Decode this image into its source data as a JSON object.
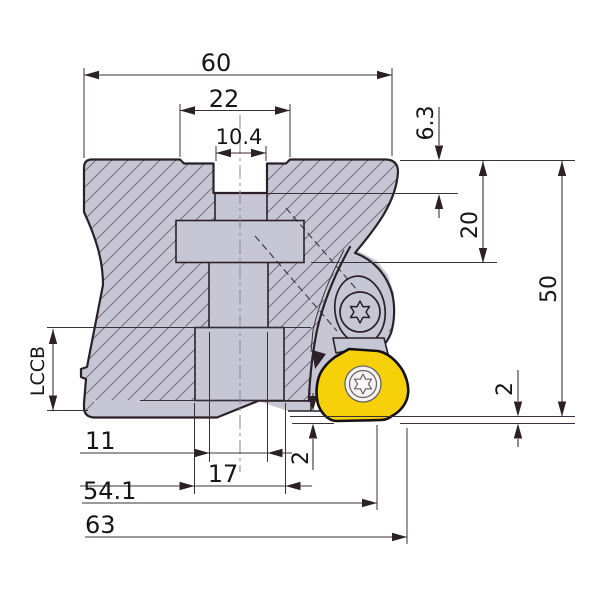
{
  "drawing": {
    "type": "technical-dimension-drawing",
    "subject": "face-mill-cutter-side-view-with-insert",
    "units_shown": "mm"
  },
  "dims": {
    "overall_width": "60",
    "boss_width": "22",
    "slot_width": "10.4",
    "slot_depth": "6.3",
    "seat_depth": "20",
    "overall_height": "50",
    "axial_offset_right": "2",
    "edge_length": "LCCB",
    "bore_width": "11",
    "hub_width": "17",
    "tip_offset": "2",
    "effective_dia": "54.1",
    "max_dia": "63"
  },
  "colors": {
    "body_fill": "#c7c6d4",
    "hatch_line": "#756e80",
    "outline": "#2b2127",
    "insert_yellow": "#f6d10a",
    "screw_face": "#f5f3ef",
    "dimension_line": "#38313a",
    "background": "#ffffff"
  }
}
